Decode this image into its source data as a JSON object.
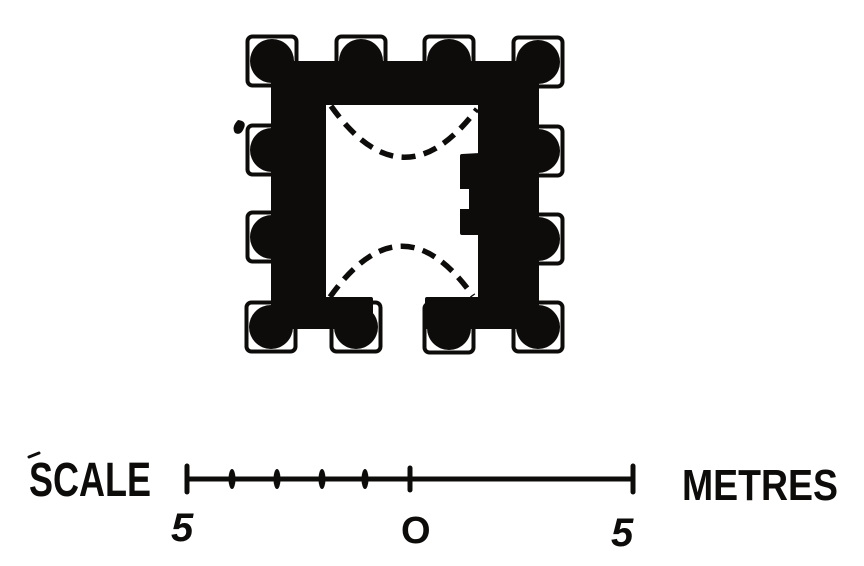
{
  "figure": {
    "type": "archaeological-building-plan",
    "ink": "#0d0c0a",
    "paper": "#ffffff"
  },
  "plan": {
    "wall_path": "M273 63 L537 63 L537 327 L427 327 L427 299 L480 299 L480 233 L462 233 L462 156 L480 155 L480 103 L324 103 L324 299 L371 299 L371 327 L273 327 Z",
    "arch_north_path": "M331 106 Q403 207 477 109",
    "arch_south_path": "M330 297 Q402 196 473 296",
    "pilaster_gap_notch_path": "M459 189 L469 189 L469 209 L459 209 Z",
    "ink_blemish_path": "M238 120 Q247 121 244 128 Q241 136 235 133 Q231 127 238 120 Z",
    "buttress_square_size": 49,
    "buttress_corner_radius": 5,
    "buttress_circle_radius": 22,
    "buttresses": [
      [
        272,
        61
      ],
      [
        361,
        61
      ],
      [
        449,
        61
      ],
      [
        538,
        62
      ],
      [
        272,
        150
      ],
      [
        272,
        237
      ],
      [
        538,
        151
      ],
      [
        538,
        239
      ],
      [
        271,
        327
      ],
      [
        356,
        327
      ],
      [
        449,
        328
      ],
      [
        538,
        327
      ]
    ]
  },
  "scale_bar": {
    "label_left": "SCALE",
    "unit_label": "METRES",
    "tick_labels": {
      "left": "5",
      "zero": "O",
      "right": "5"
    },
    "accent_mark_path": "M29 457 L39 453",
    "line": {
      "x1": 187,
      "x2": 633,
      "y": 479
    },
    "end_ticks_x": [
      187,
      633
    ],
    "zero_tick_x": 410,
    "minor_ticks_x": [
      232,
      277,
      322,
      365
    ],
    "end_tick_half_height": 13,
    "zero_tick_half_height": 11,
    "minor_tick_rx": 3.5,
    "minor_tick_ry": 10
  }
}
